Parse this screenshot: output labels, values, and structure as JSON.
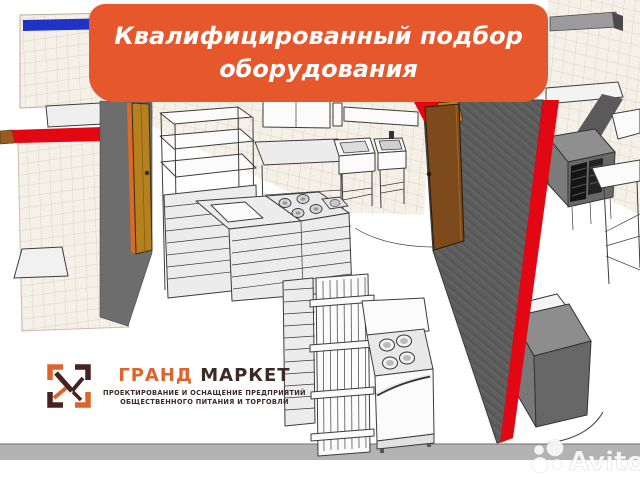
{
  "banner": {
    "line1": "Квалифицированный подбор",
    "line2": "оборудования",
    "bg_color": "#E7572C",
    "text_color": "#FFFFFF"
  },
  "logo": {
    "title_part1": "ГРАНД",
    "title_part2": " МАРКЕТ",
    "tagline_line1": "ПРОЕКТИРОВАНИЕ И ОСНАЩЕНИЕ ПРЕДПРИЯТИЙ",
    "tagline_line2": "ОБЩЕСТВЕННОГО ПИТАНИЯ И ТОРГОВЛИ",
    "orange_color": "#DD652C",
    "dark_color": "#3B2A26"
  },
  "watermark": {
    "text": "Avito"
  },
  "scene": {
    "subject": "3D plan render of commercial kitchen with equipment",
    "colors": {
      "wall_cut_red": "#E30613",
      "wall_gray": "#6D6D6D",
      "wall_dark_hatch": "#5D5D5D",
      "door_gold": "#B5801E",
      "door_brown": "#7D4A1C",
      "tile_bg": "#F6F1E8",
      "tile_line": "#DCD3C2",
      "baseboard_gray": "#B3B3B3",
      "blue_stripe": "#1E34C8"
    }
  }
}
